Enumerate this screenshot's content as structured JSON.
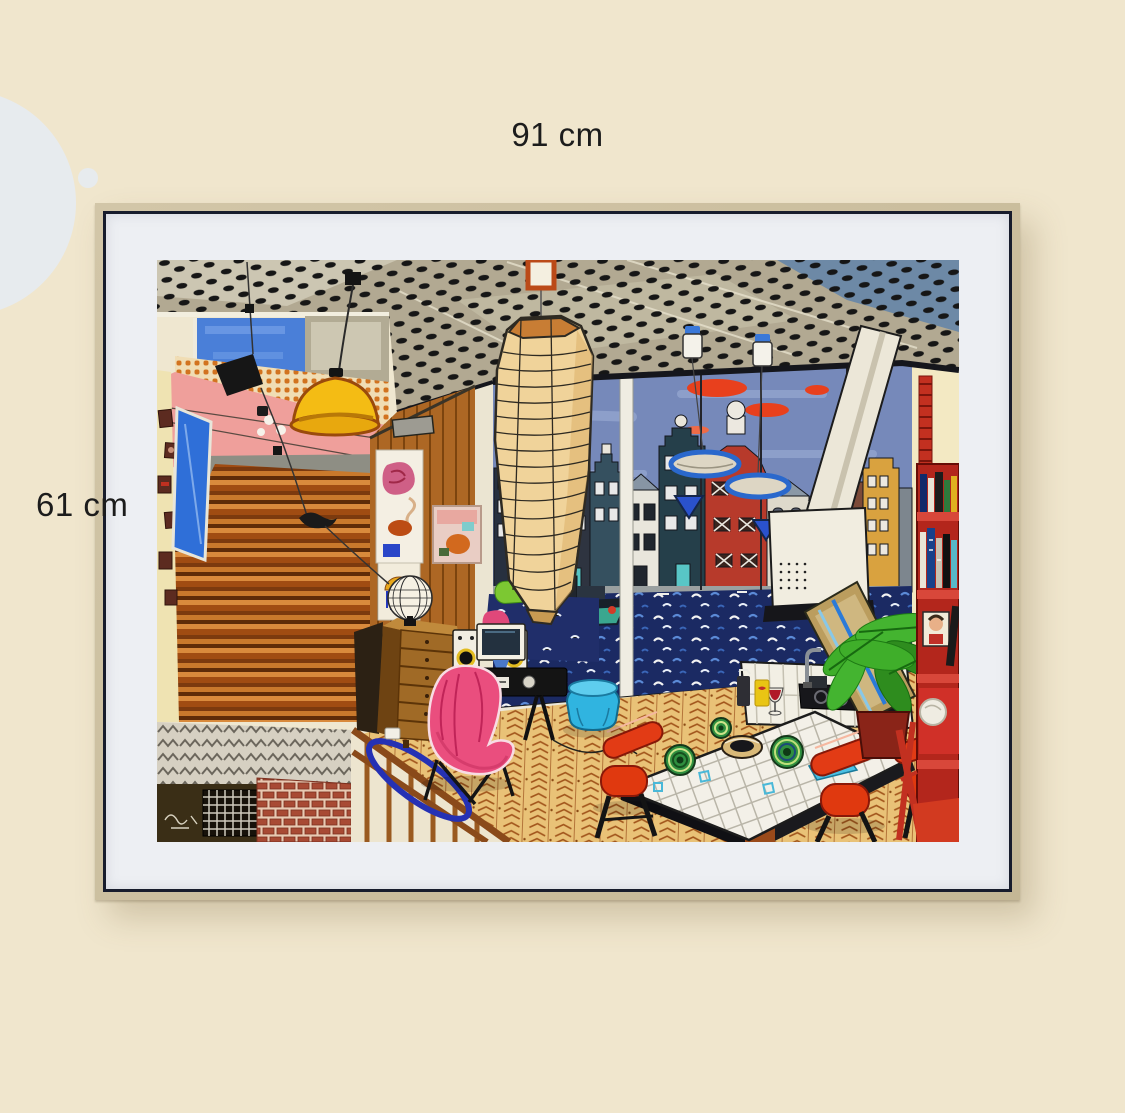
{
  "page": {
    "background_color": "#f0e6cd",
    "decor": {
      "large_circle_color": "#e7ebee",
      "small_circle_color": "#e7ebee"
    }
  },
  "dimension_labels": {
    "width": "91 cm",
    "height": "61 cm"
  },
  "frame": {
    "frame_color": "#cabea1",
    "liner_color": "#171c2c",
    "mat_color": "#edeff3"
  },
  "artwork": {
    "description": "naive-style painting of a canal-house interior: dotted ceiling, wooden staircase, paper lantern, window onto Amsterdam canal houses, tiled kitchen island with red stools, red bookshelf",
    "signature_present": true,
    "palette": {
      "ceiling_greige": "#b2a992",
      "ceiling_dots": "#161616",
      "sky_blue": "#7689ba",
      "cloud_red": "#e8401d",
      "canal_navy": "#1b2a63",
      "stair_orange": "#b05f1e",
      "wood_wall": "#ad6724",
      "lantern_cream": "#f0d39a",
      "lamp_yellow": "#f4bc14",
      "chair_pink": "#ea4e7e",
      "pouf_cyan": "#30b4e0",
      "stool_red": "#e23b15",
      "bookshelf_red": "#b3261c",
      "floor_tan": "#e9c277",
      "house_red": "#c23f2c",
      "house_ochre": "#d9a23f"
    }
  }
}
